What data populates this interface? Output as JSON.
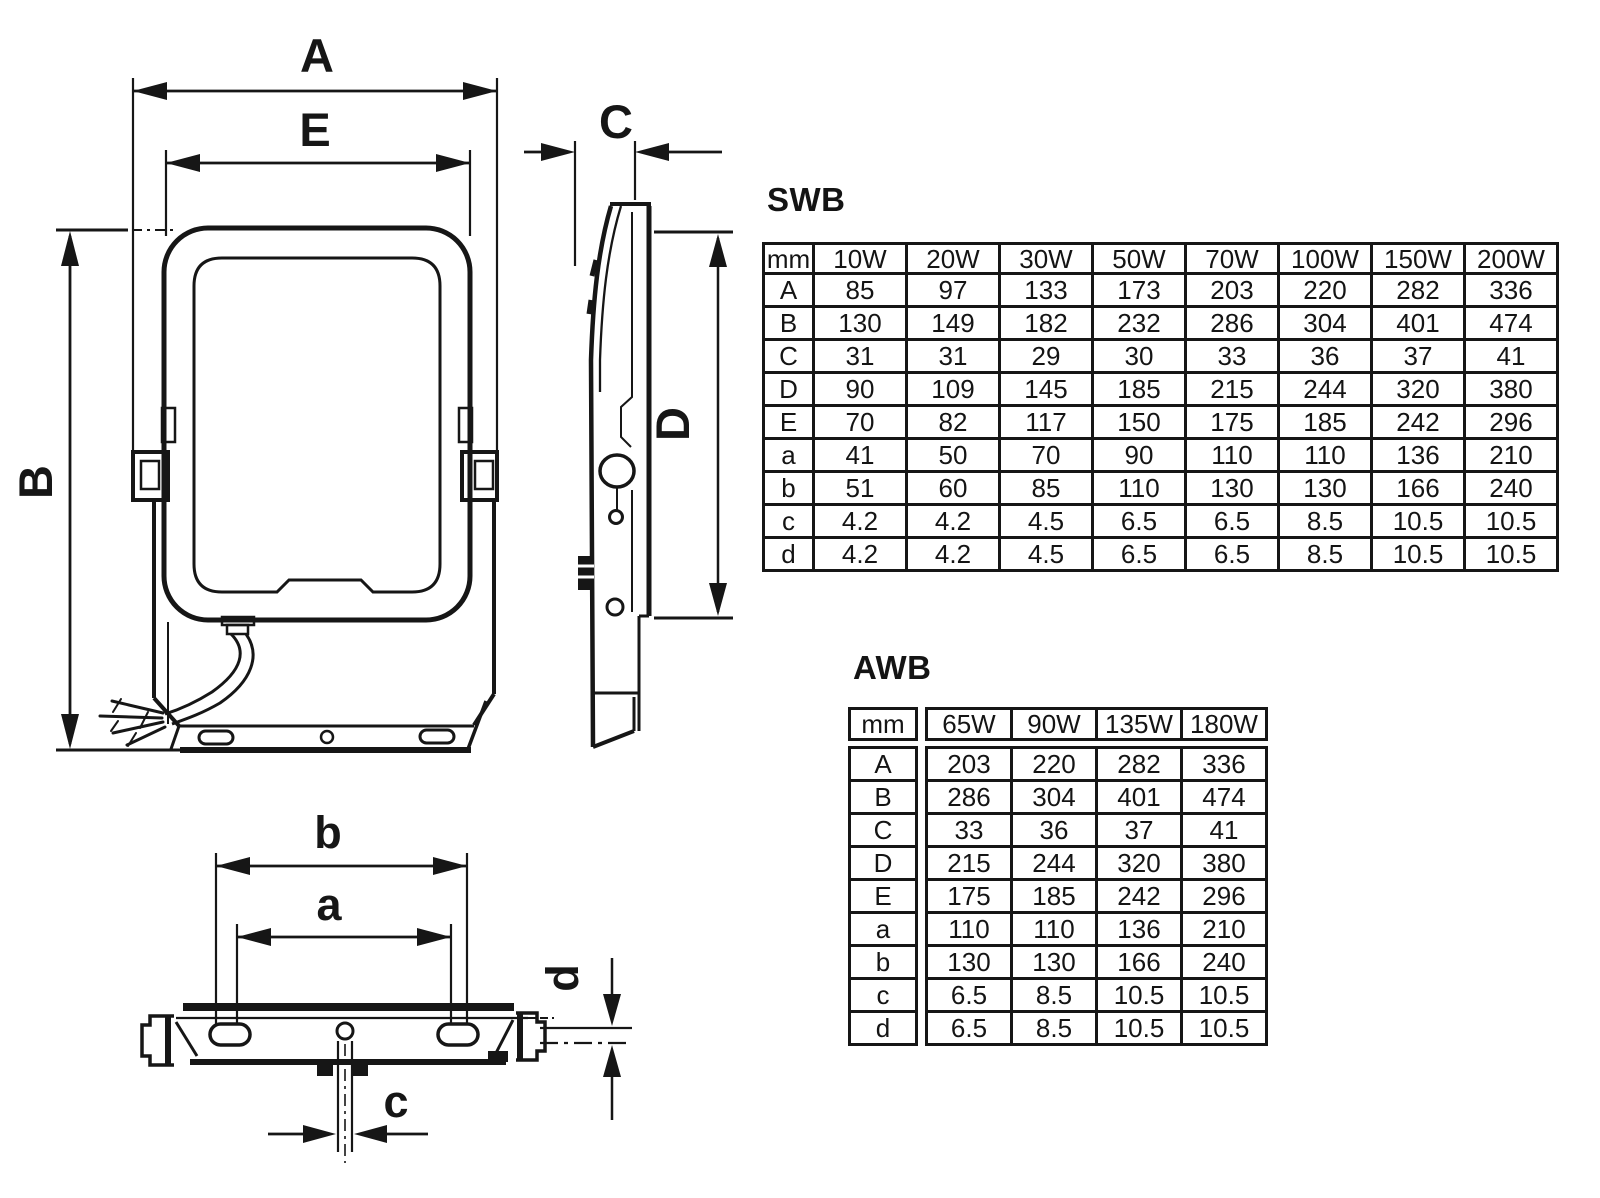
{
  "page": {
    "background": "#ffffff",
    "line_color": "#161616"
  },
  "dimension_labels": {
    "A": "A",
    "B": "B",
    "C": "C",
    "D": "D",
    "E": "E",
    "a": "a",
    "b": "b",
    "c": "c",
    "d": "d"
  },
  "tables": {
    "swb": {
      "title": "SWB",
      "headers": [
        "mm",
        "10W",
        "20W",
        "30W",
        "50W",
        "70W",
        "100W",
        "150W",
        "200W"
      ],
      "rows": [
        {
          "label": "A",
          "values": [
            "85",
            "97",
            "133",
            "173",
            "203",
            "220",
            "282",
            "336"
          ]
        },
        {
          "label": "B",
          "values": [
            "130",
            "149",
            "182",
            "232",
            "286",
            "304",
            "401",
            "474"
          ]
        },
        {
          "label": "C",
          "values": [
            "31",
            "31",
            "29",
            "30",
            "33",
            "36",
            "37",
            "41"
          ]
        },
        {
          "label": "D",
          "values": [
            "90",
            "109",
            "145",
            "185",
            "215",
            "244",
            "320",
            "380"
          ]
        },
        {
          "label": "E",
          "values": [
            "70",
            "82",
            "117",
            "150",
            "175",
            "185",
            "242",
            "296"
          ]
        },
        {
          "label": "a",
          "values": [
            "41",
            "50",
            "70",
            "90",
            "110",
            "110",
            "136",
            "210"
          ]
        },
        {
          "label": "b",
          "values": [
            "51",
            "60",
            "85",
            "110",
            "130",
            "130",
            "166",
            "240"
          ]
        },
        {
          "label": "c",
          "values": [
            "4.2",
            "4.2",
            "4.5",
            "6.5",
            "6.5",
            "8.5",
            "10.5",
            "10.5"
          ]
        },
        {
          "label": "d",
          "values": [
            "4.2",
            "4.2",
            "4.5",
            "6.5",
            "6.5",
            "8.5",
            "10.5",
            "10.5"
          ]
        }
      ]
    },
    "awb": {
      "title": "AWB",
      "headers": [
        "mm",
        "65W",
        "90W",
        "135W",
        "180W"
      ],
      "rows": [
        {
          "label": "A",
          "values": [
            "203",
            "220",
            "282",
            "336"
          ]
        },
        {
          "label": "B",
          "values": [
            "286",
            "304",
            "401",
            "474"
          ]
        },
        {
          "label": "C",
          "values": [
            "33",
            "36",
            "37",
            "41"
          ]
        },
        {
          "label": "D",
          "values": [
            "215",
            "244",
            "320",
            "380"
          ]
        },
        {
          "label": "E",
          "values": [
            "175",
            "185",
            "242",
            "296"
          ]
        },
        {
          "label": "a",
          "values": [
            "110",
            "110",
            "136",
            "210"
          ]
        },
        {
          "label": "b",
          "values": [
            "130",
            "130",
            "166",
            "240"
          ]
        },
        {
          "label": "c",
          "values": [
            "6.5",
            "8.5",
            "10.5",
            "10.5"
          ]
        },
        {
          "label": "d",
          "values": [
            "6.5",
            "8.5",
            "10.5",
            "10.5"
          ]
        }
      ]
    }
  }
}
